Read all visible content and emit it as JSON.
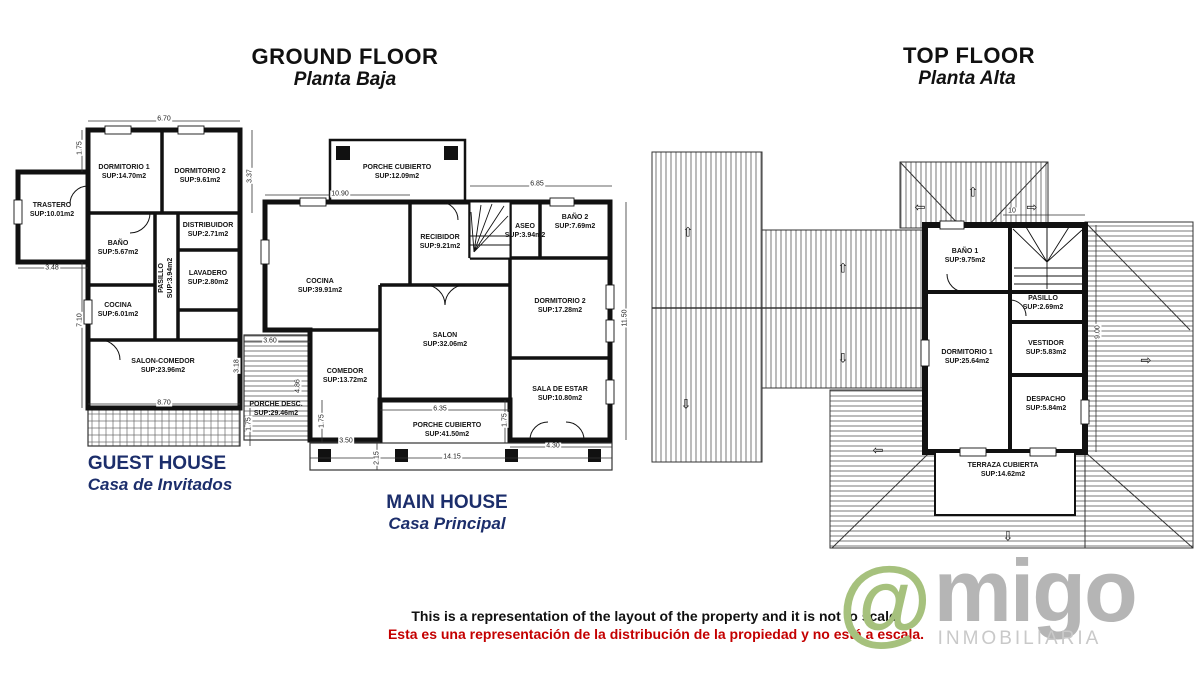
{
  "titles": {
    "ground": {
      "en": "GROUND FLOOR",
      "es": "Planta Baja"
    },
    "top": {
      "en": "TOP FLOOR",
      "es": "Planta Alta"
    }
  },
  "houses": {
    "guest": {
      "en": "GUEST HOUSE",
      "es": "Casa de Invitados"
    },
    "main": {
      "en": "MAIN HOUSE",
      "es": "Casa Principal"
    }
  },
  "gf": {
    "guest_rooms": [
      {
        "name": "TRASTERO",
        "sup": "SUP:10.01m2"
      },
      {
        "name": "DORMITORIO 1",
        "sup": "SUP:14.70m2"
      },
      {
        "name": "DORMITORIO 2",
        "sup": "SUP:9.61m2"
      },
      {
        "name": "DISTRIBUIDOR",
        "sup": "SUP:2.71m2"
      },
      {
        "name": "PASILLO",
        "sup": "SUP:3.94m2"
      },
      {
        "name": "BAÑO",
        "sup": "SUP:5.67m2"
      },
      {
        "name": "LAVADERO",
        "sup": "SUP:2.80m2"
      },
      {
        "name": "COCINA",
        "sup": "SUP:6.01m2"
      },
      {
        "name": "SALON-COMEDOR",
        "sup": "SUP:23.96m2"
      }
    ],
    "main_rooms": [
      {
        "name": "PORCHE CUBIERTO",
        "sup": "SUP:12.09m2"
      },
      {
        "name": "COCINA",
        "sup": "SUP:39.91m2"
      },
      {
        "name": "RECIBIDOR",
        "sup": "SUP:9.21m2"
      },
      {
        "name": "ASEO",
        "sup": "SUP:3.94m2"
      },
      {
        "name": "BAÑO 2",
        "sup": "SUP:7.69m2"
      },
      {
        "name": "DORMITORIO 2",
        "sup": "SUP:17.28m2"
      },
      {
        "name": "SALON",
        "sup": "SUP:32.06m2"
      },
      {
        "name": "COMEDOR",
        "sup": "SUP:13.72m2"
      },
      {
        "name": "SALA DE ESTAR",
        "sup": "SUP:10.80m2"
      },
      {
        "name": "PORCHE DESC.",
        "sup": "SUP:29.46m2"
      },
      {
        "name": "PORCHE CUBIERTO",
        "sup": "SUP:41.50m2"
      }
    ],
    "dims": [
      "6.70",
      "1.75",
      "3.37",
      "3.48",
      "7.10",
      "8.70",
      "1.75",
      "10.90",
      "6.85",
      "11.50",
      "3.60",
      "3.18",
      "4.86",
      "1.75",
      "1.75",
      "6.35",
      "3.50",
      "4.30",
      "14.15",
      "2.15"
    ]
  },
  "tf": {
    "rooms": [
      {
        "name": "BAÑO 1",
        "sup": "SUP:9.75m2"
      },
      {
        "name": "PASILLO",
        "sup": "SUP:2.69m2"
      },
      {
        "name": "DORMITORIO 1",
        "sup": "SUP:25.64m2"
      },
      {
        "name": "VESTIDOR",
        "sup": "SUP:5.83m2"
      },
      {
        "name": "DESPACHO",
        "sup": "SUP:5.84m2"
      },
      {
        "name": "TERRAZA CUBIERTA",
        "sup": "SUP:14.62m2"
      }
    ],
    "dims": [
      "10",
      "9.00"
    ]
  },
  "disclaimer": {
    "en": "This is a representation of the layout of the property and it is not to scale.",
    "es": "Esta es una representación de la distribución de la propiedad y no está a escala."
  },
  "logo": {
    "at": "@",
    "name": "migo",
    "subtitle": "INMOBILIARIA"
  },
  "icons": {
    "up": "⇧",
    "down": "⇩",
    "left": "⇦",
    "right": "⇨"
  },
  "colors": {
    "navy": "#1c2e6b",
    "red": "#c40000",
    "logo_green": "#a6c17d",
    "logo_gray": "#b5b5b5"
  }
}
